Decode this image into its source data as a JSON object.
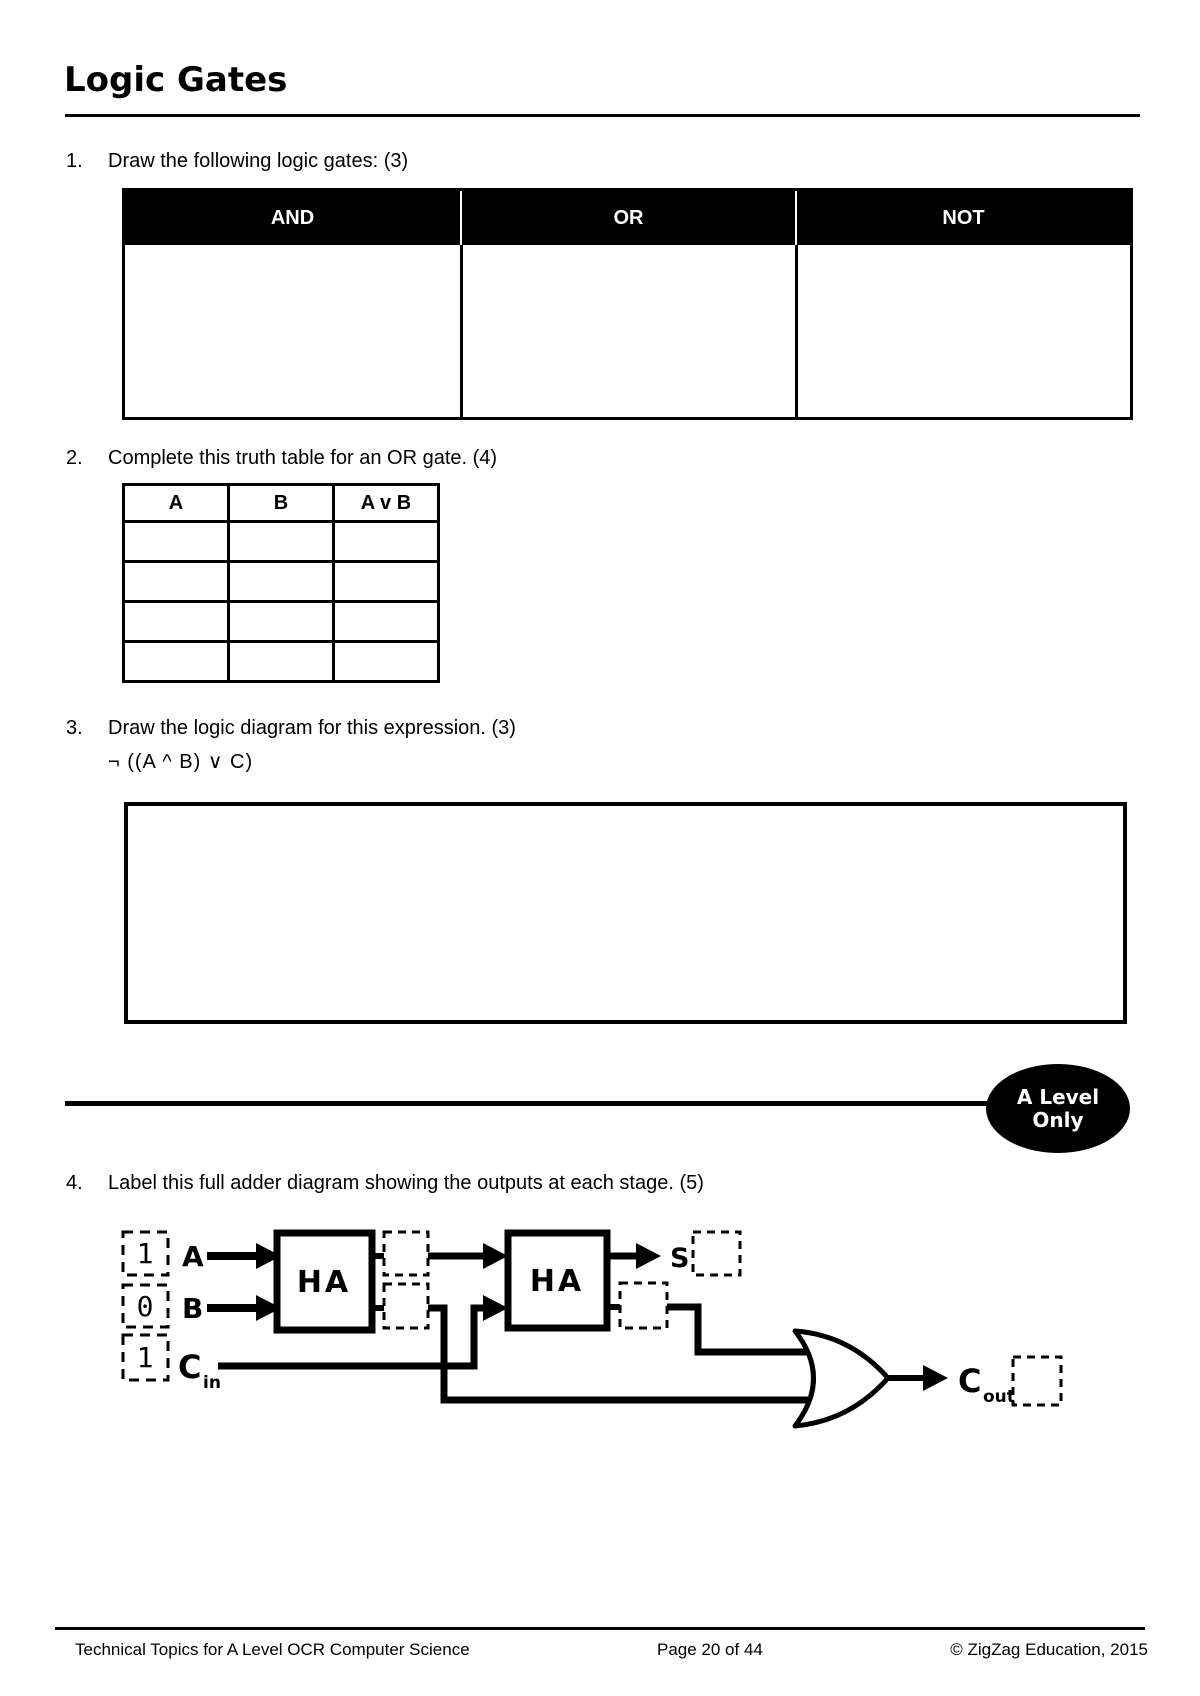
{
  "title": "Logic Gates",
  "questions": {
    "q1": {
      "number": "1.",
      "text": "Draw the following logic gates: (3)",
      "headers": [
        "AND",
        "OR",
        "NOT"
      ]
    },
    "q2": {
      "number": "2.",
      "text": "Complete this truth table for an OR gate. (4)",
      "headers": [
        "A",
        "B",
        "A v B"
      ],
      "empty_rows": 4
    },
    "q3": {
      "number": "3.",
      "text": "Draw the logic diagram for this expression. (3)",
      "expression": "¬ ((A ^ B) ∨ C)"
    },
    "q4": {
      "number": "4.",
      "text": "Label this full adder diagram showing the outputs at each stage. (5)"
    }
  },
  "badge": {
    "line1": "A Level",
    "line2": "Only"
  },
  "diagram": {
    "input_values": [
      "1",
      "0",
      "1"
    ],
    "input_labels": {
      "a": "A",
      "b": "B",
      "cin_base": "C",
      "cin_sub": "in"
    },
    "gates": {
      "ha1": "HA",
      "ha2": "HA",
      "carry_or": "OR"
    },
    "outputs": {
      "sum": "S",
      "cout_base": "C",
      "cout_sub": "out"
    }
  },
  "footer": {
    "left": "Technical Topics for A Level OCR Computer Science",
    "center": "Page 20 of 44",
    "right": "© ZigZag Education, 2015"
  },
  "colors": {
    "ink": "#000000",
    "paper": "#ffffff",
    "header_bg": "#000000",
    "header_fg": "#ffffff"
  }
}
